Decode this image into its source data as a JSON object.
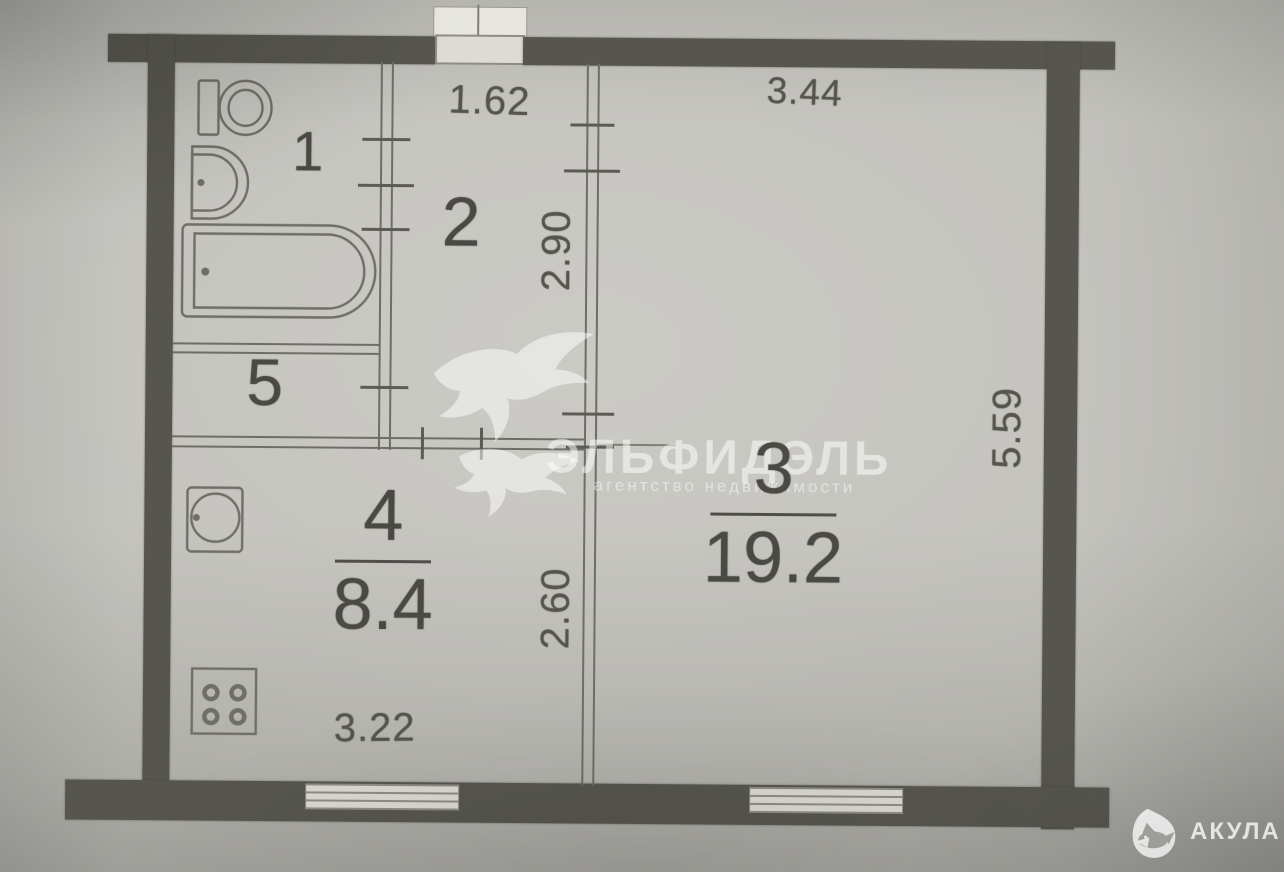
{
  "plan": {
    "rooms": {
      "r1": {
        "number": "1"
      },
      "r2": {
        "number": "2"
      },
      "r3": {
        "number": "3",
        "area": "19.2"
      },
      "r4": {
        "number": "4",
        "area": "8.4"
      },
      "r5": {
        "number": "5"
      }
    },
    "dimensions": {
      "entry_opening_width": "1.62",
      "room3_width": "3.44",
      "room2_depth": "2.90",
      "room3_depth": "5.59",
      "room4_depth": "2.60",
      "room4_width": "3.22"
    },
    "fixture_icons": [
      "toilet-icon",
      "washbasin-icon",
      "bathtub-icon",
      "kitchen-sink-icon",
      "stove-icon"
    ]
  },
  "watermark": {
    "brand": "ЭЛЬФИДЭЛЬ",
    "subtitle": "агентство недвижимости",
    "bird_icon": "swallow-icon"
  },
  "agency_logo": {
    "text": "АКУЛА",
    "icon": "shark-drop-icon"
  },
  "colors": {
    "paper": "#bcbbb5",
    "wall_ink": "#56554f",
    "line_ink": "#6e6d66",
    "label_ink": "#4a4944",
    "watermark_white": "rgba(255,255,255,0.52)"
  }
}
